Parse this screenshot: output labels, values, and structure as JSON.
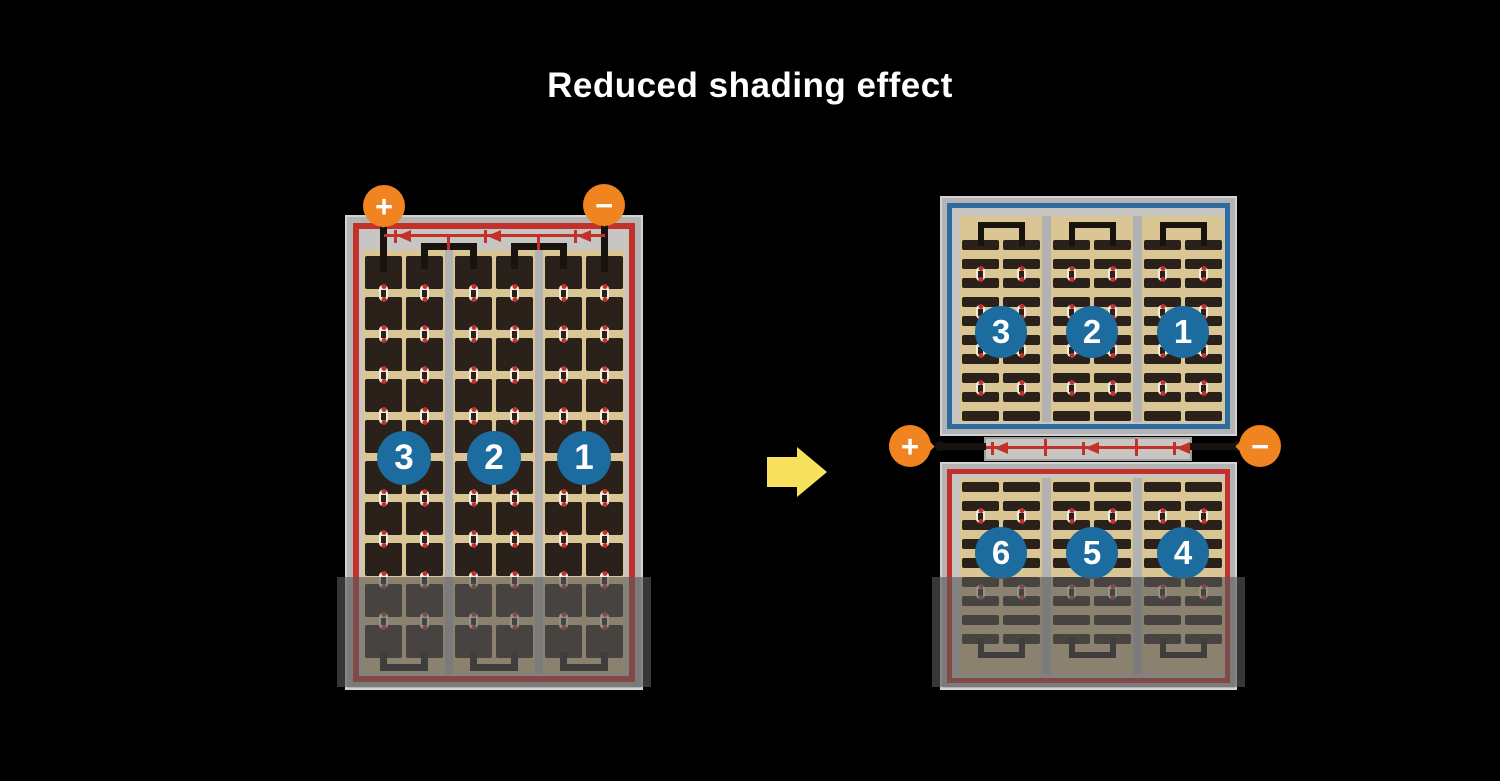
{
  "title": "Reduced shading effect",
  "colors": {
    "background": "#000000",
    "title_text": "#FFFFFF",
    "terminal_orange": "#EF8420",
    "string_circle_blue": "#1C6C9F",
    "wire_red": "#C2322A",
    "half_panel_border_blue": "#2E6B9E",
    "panel_frame_gray": "#B4B4B4",
    "panel_inner_gray": "#C8C6C2",
    "cell_field_tan": "#D9C694",
    "cell_dark": "#2A211A",
    "bus_bar_black": "#191310",
    "arrow_yellow": "#F8E15F",
    "shade_overlay": "rgba(88,88,88,0.62)"
  },
  "left_panel": {
    "terminals": {
      "plus": "+",
      "minus": "−"
    },
    "string_labels": [
      "3",
      "2",
      "1"
    ],
    "diode_count": 3,
    "grid": {
      "sections": 3,
      "columns_per_section": 2,
      "rows": 10
    },
    "shaded": true
  },
  "arrow": {
    "direction": "right"
  },
  "right_panel": {
    "terminals": {
      "plus": "+",
      "minus": "−"
    },
    "diode_count": 3,
    "top_half": {
      "string_labels": [
        "3",
        "2",
        "1"
      ],
      "grid": {
        "sections": 3,
        "columns_per_section": 2,
        "rows": 10
      }
    },
    "bottom_half": {
      "string_labels": [
        "6",
        "5",
        "4"
      ],
      "grid": {
        "sections": 3,
        "columns_per_section": 2,
        "rows": 9
      }
    },
    "shaded": true
  }
}
